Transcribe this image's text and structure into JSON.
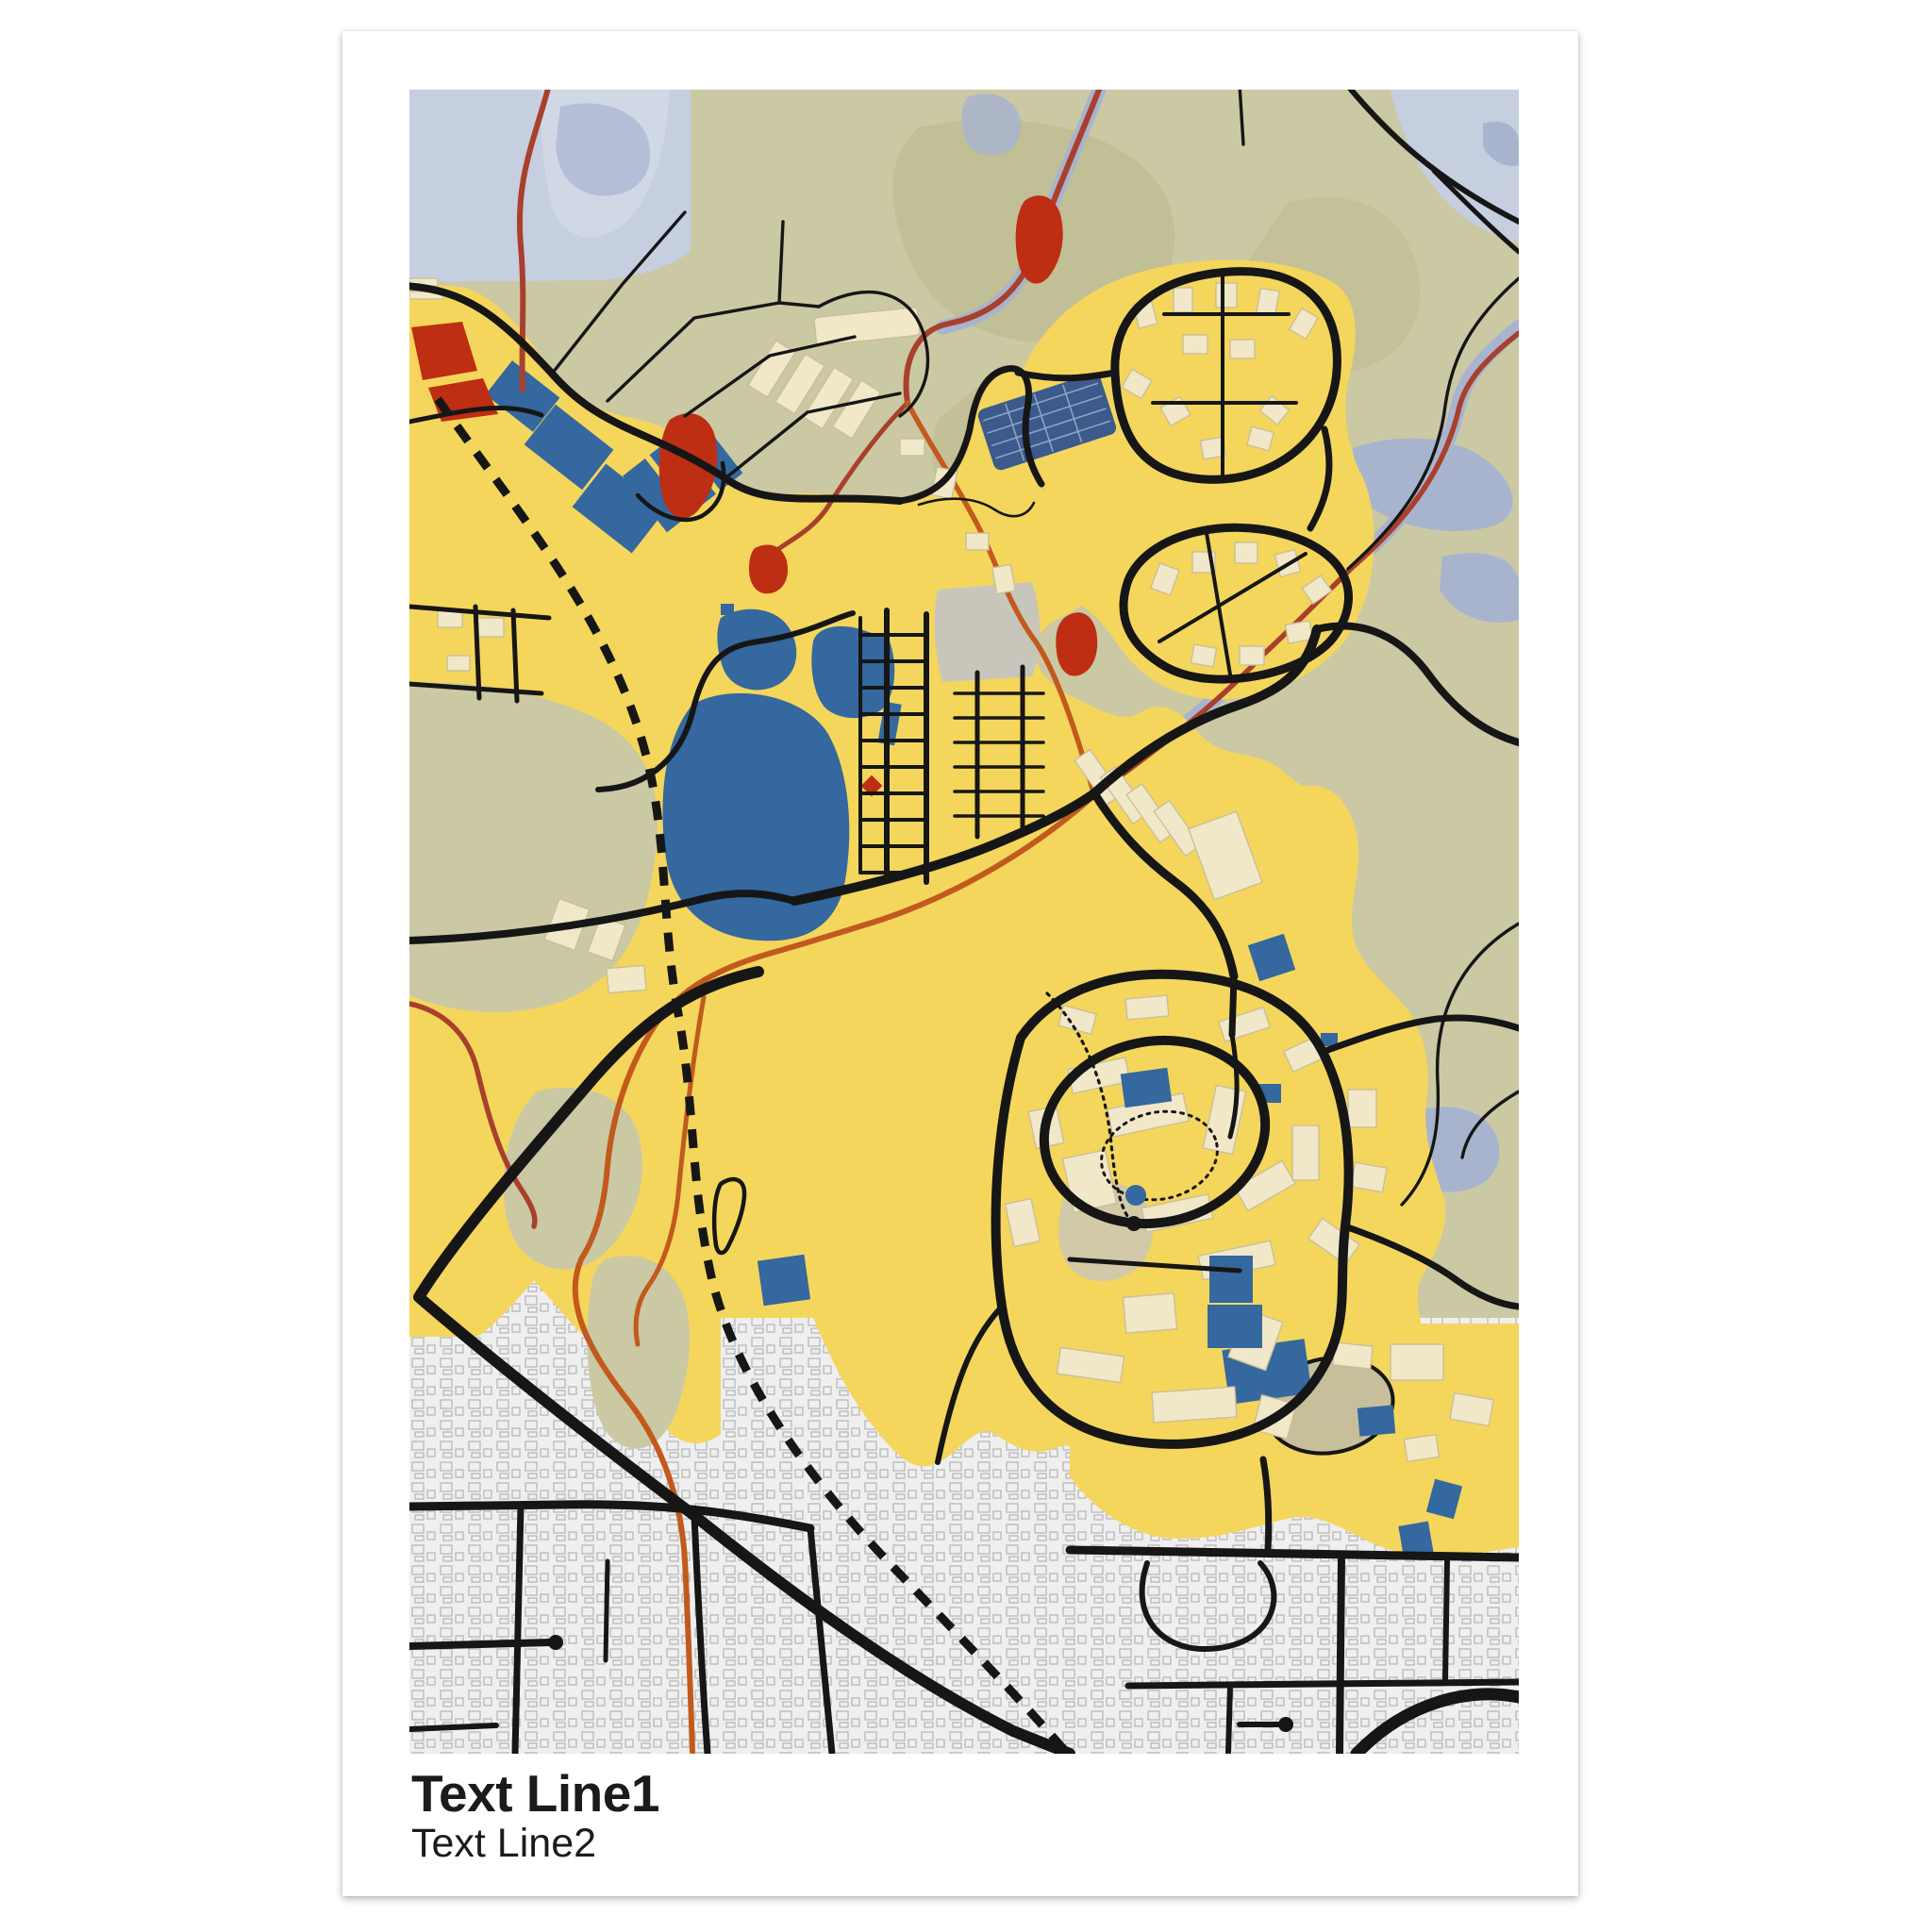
{
  "page": {
    "background": "#ffffff"
  },
  "poster": {
    "title": "Text Line1",
    "subtitle": "Text Line2",
    "background": "#ffffff"
  },
  "map": {
    "style": "mondrian-city-map-print",
    "palette": {
      "urban_yellow": "#f4d65c",
      "terrain_olive": "#cbc8a4",
      "terrain_olive_dark": "#c0bd94",
      "plaza_gray": "#c8c6ba",
      "track_gray": "#c7bf9b",
      "water_light": "#c5cfe0",
      "water_lighter": "#d0d8e6",
      "water_medium": "#a8b4ce",
      "water_blue": "#34689e",
      "water_navy": "#3c5a8c",
      "terrace_hatch": "#8fa2c4",
      "accent_red": "#bd2e12",
      "stream_dark_red": "#a8402c",
      "stream_orange": "#c2591d",
      "building_beige": "#f1e8c9",
      "building_outline": "#c9bf98",
      "residential_bg": "#efefef",
      "residential_outline": "#b7b7b7",
      "road_black": "#161616",
      "text_color": "#1b1b1b"
    }
  }
}
